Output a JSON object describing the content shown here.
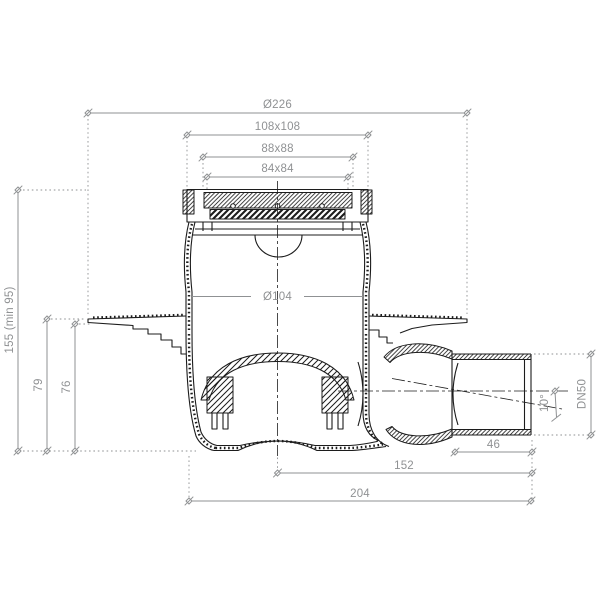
{
  "drawing": {
    "type": "technical-section-drawing",
    "subject": "floor drain body with horizontal outlet, cross-section with dimensions",
    "colors": {
      "geometry": "#1c1c1c",
      "dimension": "#8f9193",
      "background": "#ffffff"
    },
    "dimensions": {
      "top": [
        {
          "id": "flange-diameter",
          "label": "Ø226"
        },
        {
          "id": "frame-outer-square",
          "label": "108x108"
        },
        {
          "id": "frame-inner-square",
          "label": "88x88"
        },
        {
          "id": "grate-square",
          "label": "84x84"
        }
      ],
      "body": [
        {
          "id": "body-inner-diameter",
          "label": "Ø104"
        }
      ],
      "left": [
        {
          "id": "total-height",
          "label": "155 (min 95)"
        },
        {
          "id": "height-to-flange-top",
          "label": "79"
        },
        {
          "id": "height-to-flange-seat",
          "label": "76"
        }
      ],
      "right": [
        {
          "id": "outlet-nominal-size",
          "label": "DN50"
        },
        {
          "id": "outlet-swivel-angle",
          "label": "10°"
        }
      ],
      "bottom": [
        {
          "id": "outlet-socket-length",
          "label": "46"
        },
        {
          "id": "center-to-outlet-end",
          "label": "152"
        },
        {
          "id": "overall-length",
          "label": "204"
        }
      ]
    }
  }
}
